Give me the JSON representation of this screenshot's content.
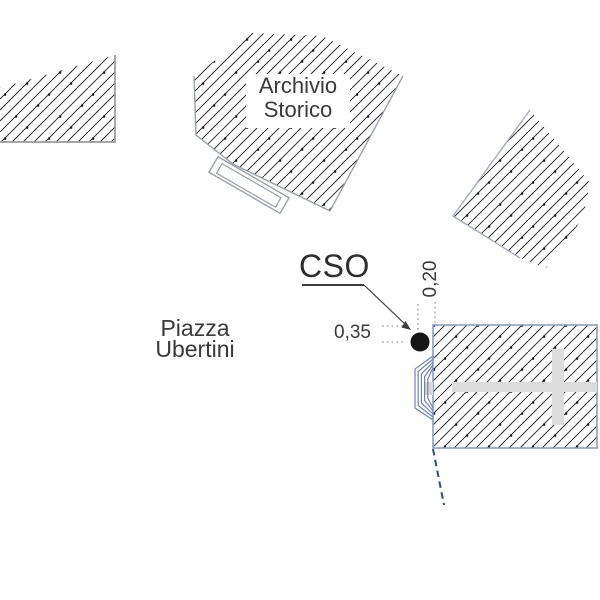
{
  "drawing": {
    "type": "architectural site plan",
    "labels": {
      "building_top": {
        "line1": "Archivio",
        "line2": "Storico"
      },
      "square": {
        "line1": "Piazza",
        "line2": "Ubertini"
      },
      "marker": "CSO",
      "dim_horizontal": "0,35",
      "dim_vertical": "0,20"
    },
    "colors": {
      "background": "#ffffff",
      "hatch_line": "#1f1f1f",
      "hatch_dot": "#141414",
      "border_gray": "#9a9a9a",
      "border_gray_blue": "#98a1ab",
      "border_blue": "#8b9cc8",
      "bracket_blue": "#6f83b8",
      "utility_line_blue": "#2e4d7b",
      "marker_dot": "#161616",
      "cross_gray": "#dcdcdc",
      "leader_line": "#3c3c3c",
      "dim_dotted_gray": "#9a9a9a",
      "text_gray": "#3a3a3a"
    }
  }
}
